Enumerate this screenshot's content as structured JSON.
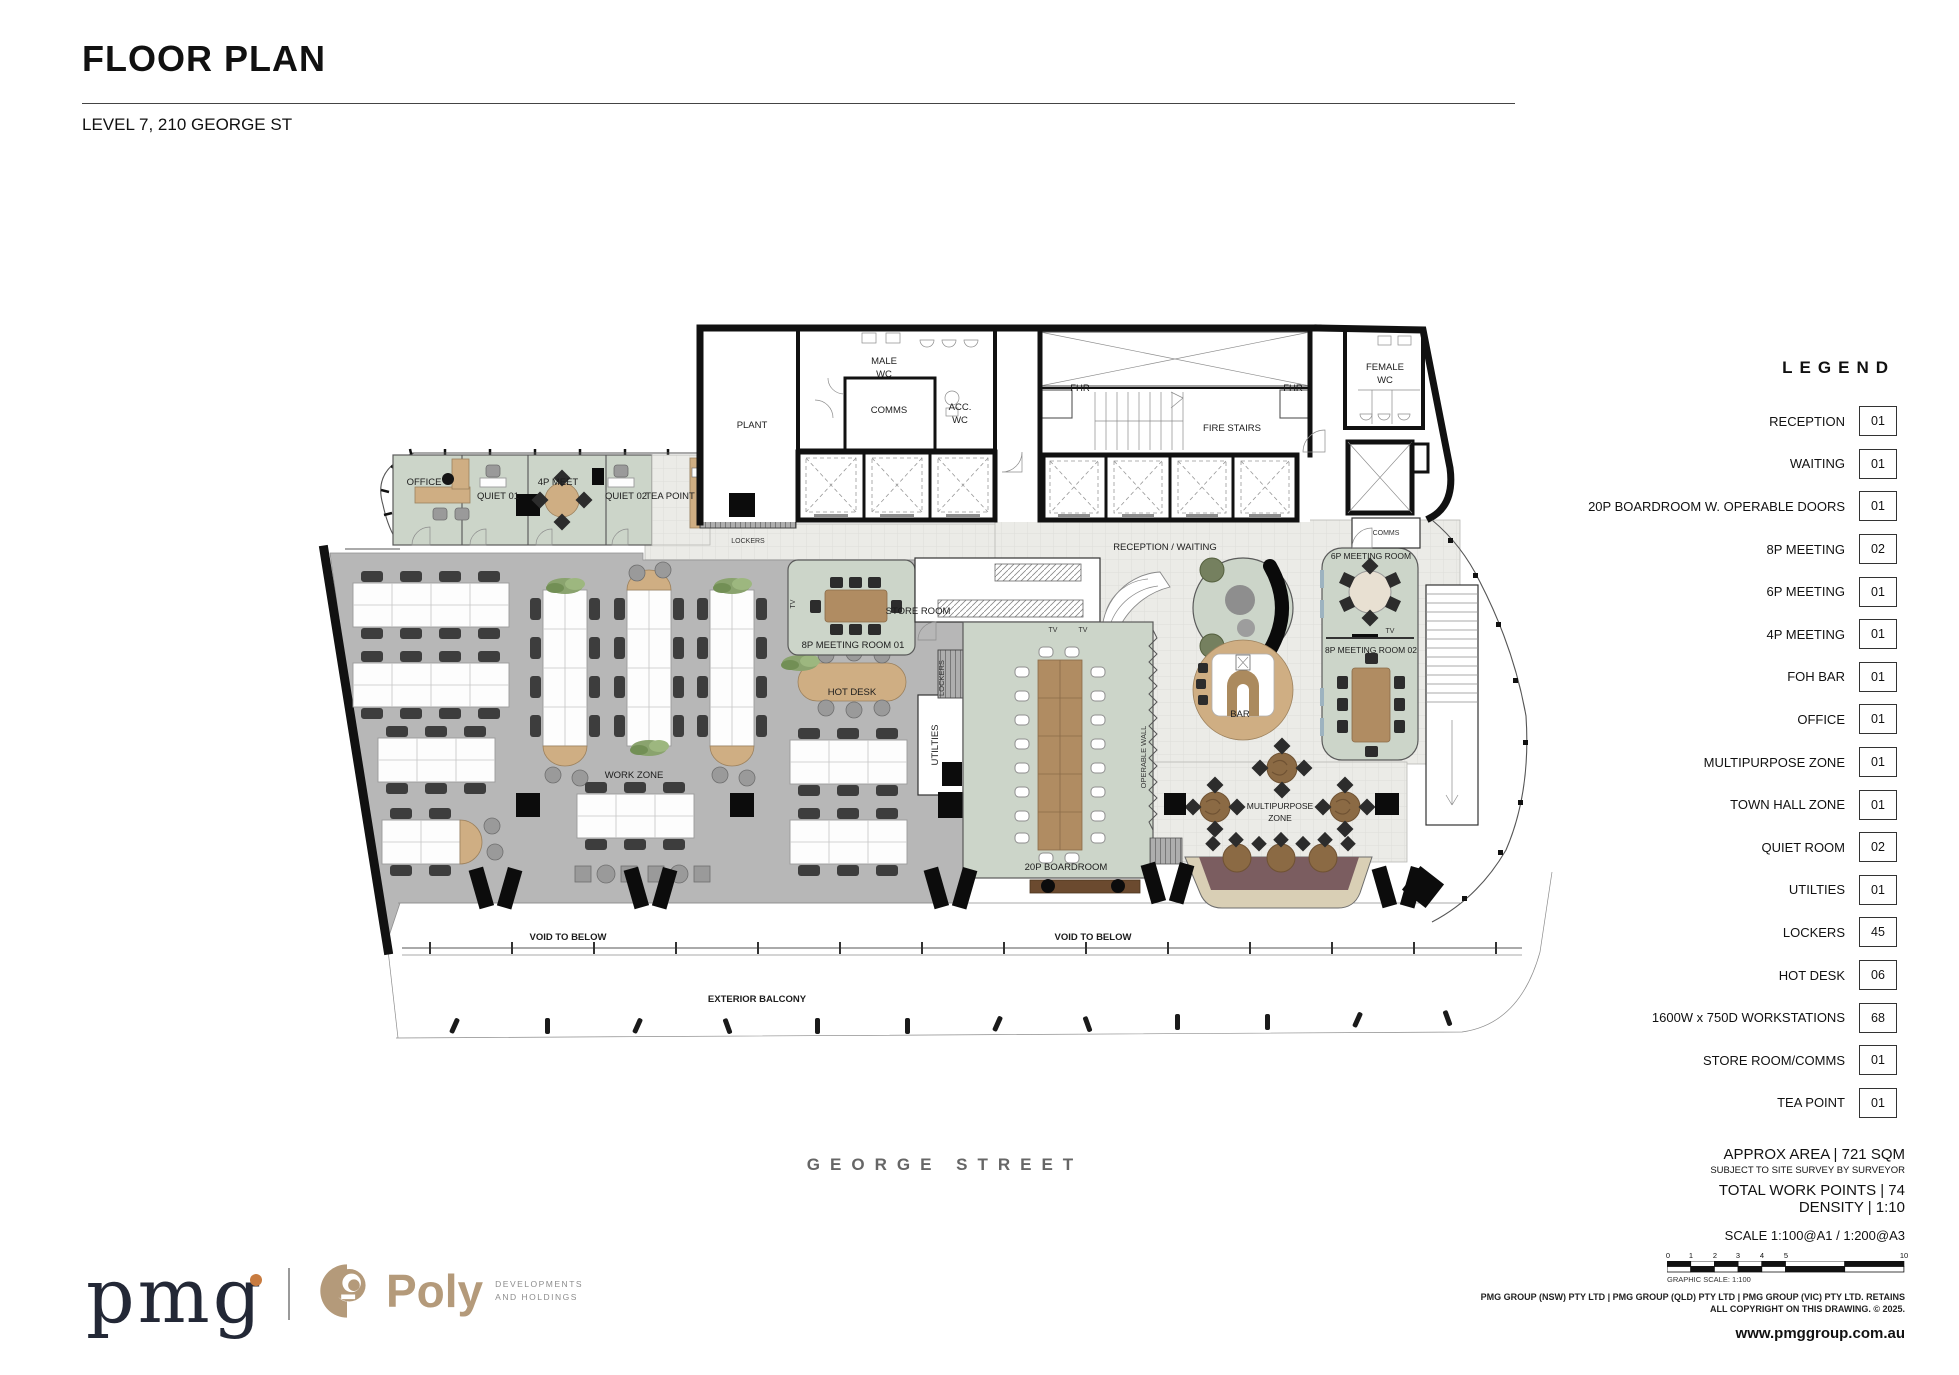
{
  "header": {
    "title": "FLOOR PLAN",
    "subtitle": "LEVEL 7, 210 GEORGE ST"
  },
  "street_label": "GEORGE STREET",
  "legend": {
    "heading": "LEGEND",
    "items": [
      {
        "label": "RECEPTION",
        "count": "01"
      },
      {
        "label": "WAITING",
        "count": "01"
      },
      {
        "label": "20P BOARDROOM W. OPERABLE DOORS",
        "count": "01"
      },
      {
        "label": "8P MEETING",
        "count": "02"
      },
      {
        "label": "6P MEETING",
        "count": "01"
      },
      {
        "label": "4P MEETING",
        "count": "01"
      },
      {
        "label": "FOH BAR",
        "count": "01"
      },
      {
        "label": "OFFICE",
        "count": "01"
      },
      {
        "label": "MULTIPURPOSE ZONE",
        "count": "01"
      },
      {
        "label": "TOWN HALL ZONE",
        "count": "01"
      },
      {
        "label": "QUIET ROOM",
        "count": "02"
      },
      {
        "label": "UTILTIES",
        "count": "01"
      },
      {
        "label": "LOCKERS",
        "count": "45"
      },
      {
        "label": "HOT DESK",
        "count": "06"
      },
      {
        "label": "1600W x 750D WORKSTATIONS",
        "count": "68"
      },
      {
        "label": "STORE ROOM/COMMS",
        "count": "01"
      },
      {
        "label": "TEA POINT",
        "count": "01"
      }
    ]
  },
  "info": {
    "area": "APPROX AREA | 721 SQM",
    "survey_note": "SUBJECT TO SITE SURVEY BY SURVEYOR",
    "work_points": "TOTAL WORK POINTS | 74",
    "density": "DENSITY | 1:10",
    "scale": "SCALE 1:100@A1 / 1:200@A3",
    "graphic_scale_caption": "GRAPHIC SCALE: 1:100",
    "scale_ticks": [
      "0",
      "1",
      "2",
      "3",
      "4",
      "5",
      "10"
    ],
    "copyright_line1": "PMG GROUP (NSW) PTY LTD | PMG GROUP (QLD) PTY LTD | PMG GROUP (VIC) PTY LTD. RETAINS",
    "copyright_line2": "ALL COPYRIGHT ON THIS DRAWING. © 2025.",
    "website": "www.pmggroup.com.au"
  },
  "logos": {
    "pmg": "pmg",
    "poly": "Poly",
    "poly_sub1": "DEVELOPMENTS",
    "poly_sub2": "AND HOLDINGS"
  },
  "plan_labels": {
    "plant": "PLANT",
    "male_wc_1": "MALE",
    "male_wc_2": "WC",
    "comms_core": "COMMS",
    "acc_wc_1": "ACC.",
    "acc_wc_2": "WC",
    "fhr": "FHR",
    "fire_stairs": "FIRE STAIRS",
    "female_wc_1": "FEMALE",
    "female_wc_2": "WC",
    "office": "OFFICE",
    "quiet01": "QUIET 01",
    "meet4p": "4P MEET",
    "quiet02": "QUIET 02",
    "tea_point": "TEA POINT",
    "lockers": "LOCKERS",
    "reception_waiting": "RECEPTION / WAITING",
    "comms_right": "COMMS",
    "meeting6p": "6P MEETING ROOM",
    "meeting8p02": "8P MEETING ROOM 02",
    "meeting8p01": "8P MEETING ROOM 01",
    "store_room": "STORE ROOM",
    "hot_desk": "HOT DESK",
    "utilities": "UTILTIES",
    "operable_wall": "OPERABLE WALL",
    "boardroom": "20P BOARDROOM",
    "work_zone": "WORK ZONE",
    "bar": "BAR",
    "multipurpose_1": "MULTIPURPOSE",
    "multipurpose_2": "ZONE",
    "void_below": "VOID TO BELOW",
    "exterior_balcony": "EXTERIOR BALCONY",
    "tv": "TV"
  },
  "colors": {
    "sage": "#ccd5c9",
    "tilefloor": "#ebebe7",
    "grayfloor": "#b7b7b7",
    "tan": "#cfae83",
    "timber": "#b08c62",
    "maroon": "#7b5d60",
    "cream_tier": "#d9cfb5",
    "chair_dark": "#3d3d3d",
    "wall": "#111111",
    "olive": "#75805f",
    "pmg_navy": "#232836",
    "pmg_orange": "#c87b3f",
    "poly_tan": "#b49a7a"
  }
}
